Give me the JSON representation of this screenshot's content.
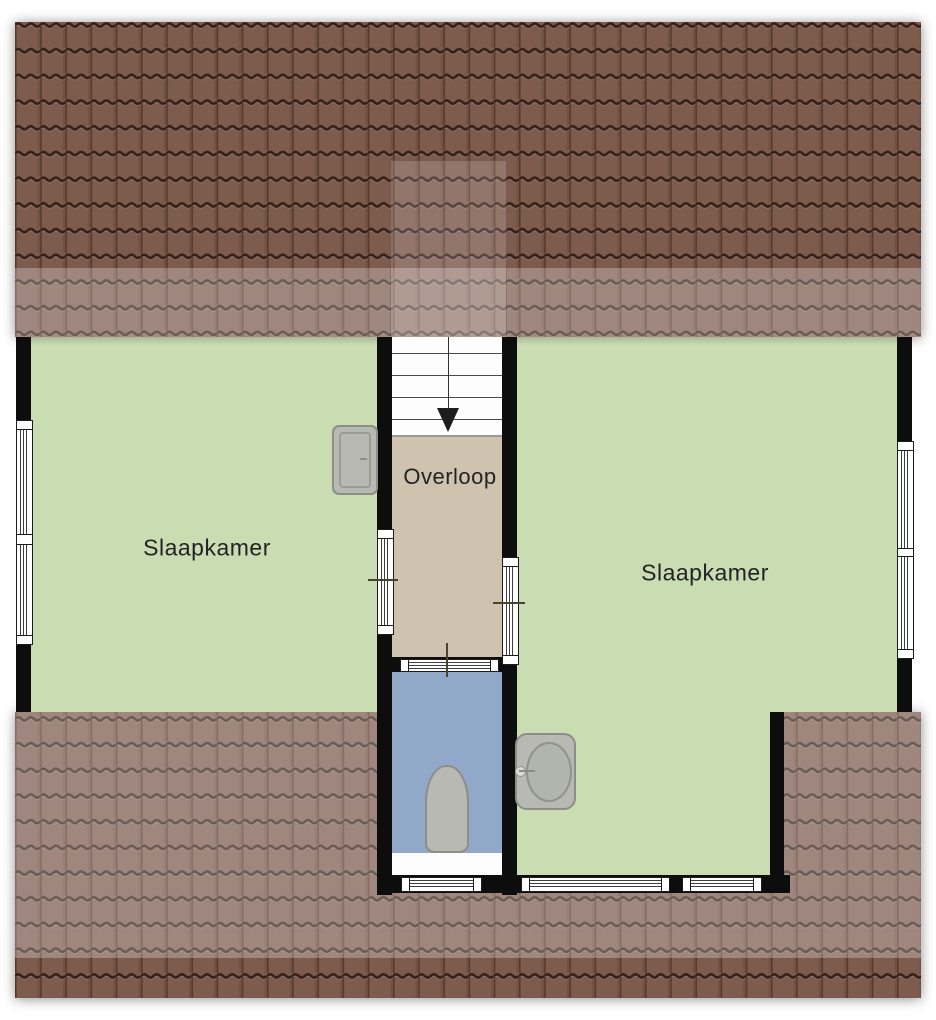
{
  "rooms": {
    "bedroom_left": {
      "label": "Slaapkamer"
    },
    "landing": {
      "label": "Overloop"
    },
    "bedroom_right": {
      "label": "Slaapkamer"
    }
  },
  "stairs": {
    "direction": "down"
  },
  "icons": {
    "toilet": "toilet-top-view",
    "sink": "washbasin-round",
    "cabinet": "wall-cabinet",
    "stairs_arrow": "arrow-down"
  },
  "colors": {
    "roof_base": "#7d5b4d",
    "roof_gap": "#361f17",
    "roof_joint": "#5a392c",
    "floor_green": "#c9dcb2",
    "floor_tan": "#cfc2ae",
    "floor_blue": "#92a8c9",
    "wall": "#0d0d0d",
    "window_frame": "#3f3f3f",
    "fixture_fill": "#b8b9b3",
    "fixture_border": "#8d8e87",
    "label_text": "#232323"
  }
}
